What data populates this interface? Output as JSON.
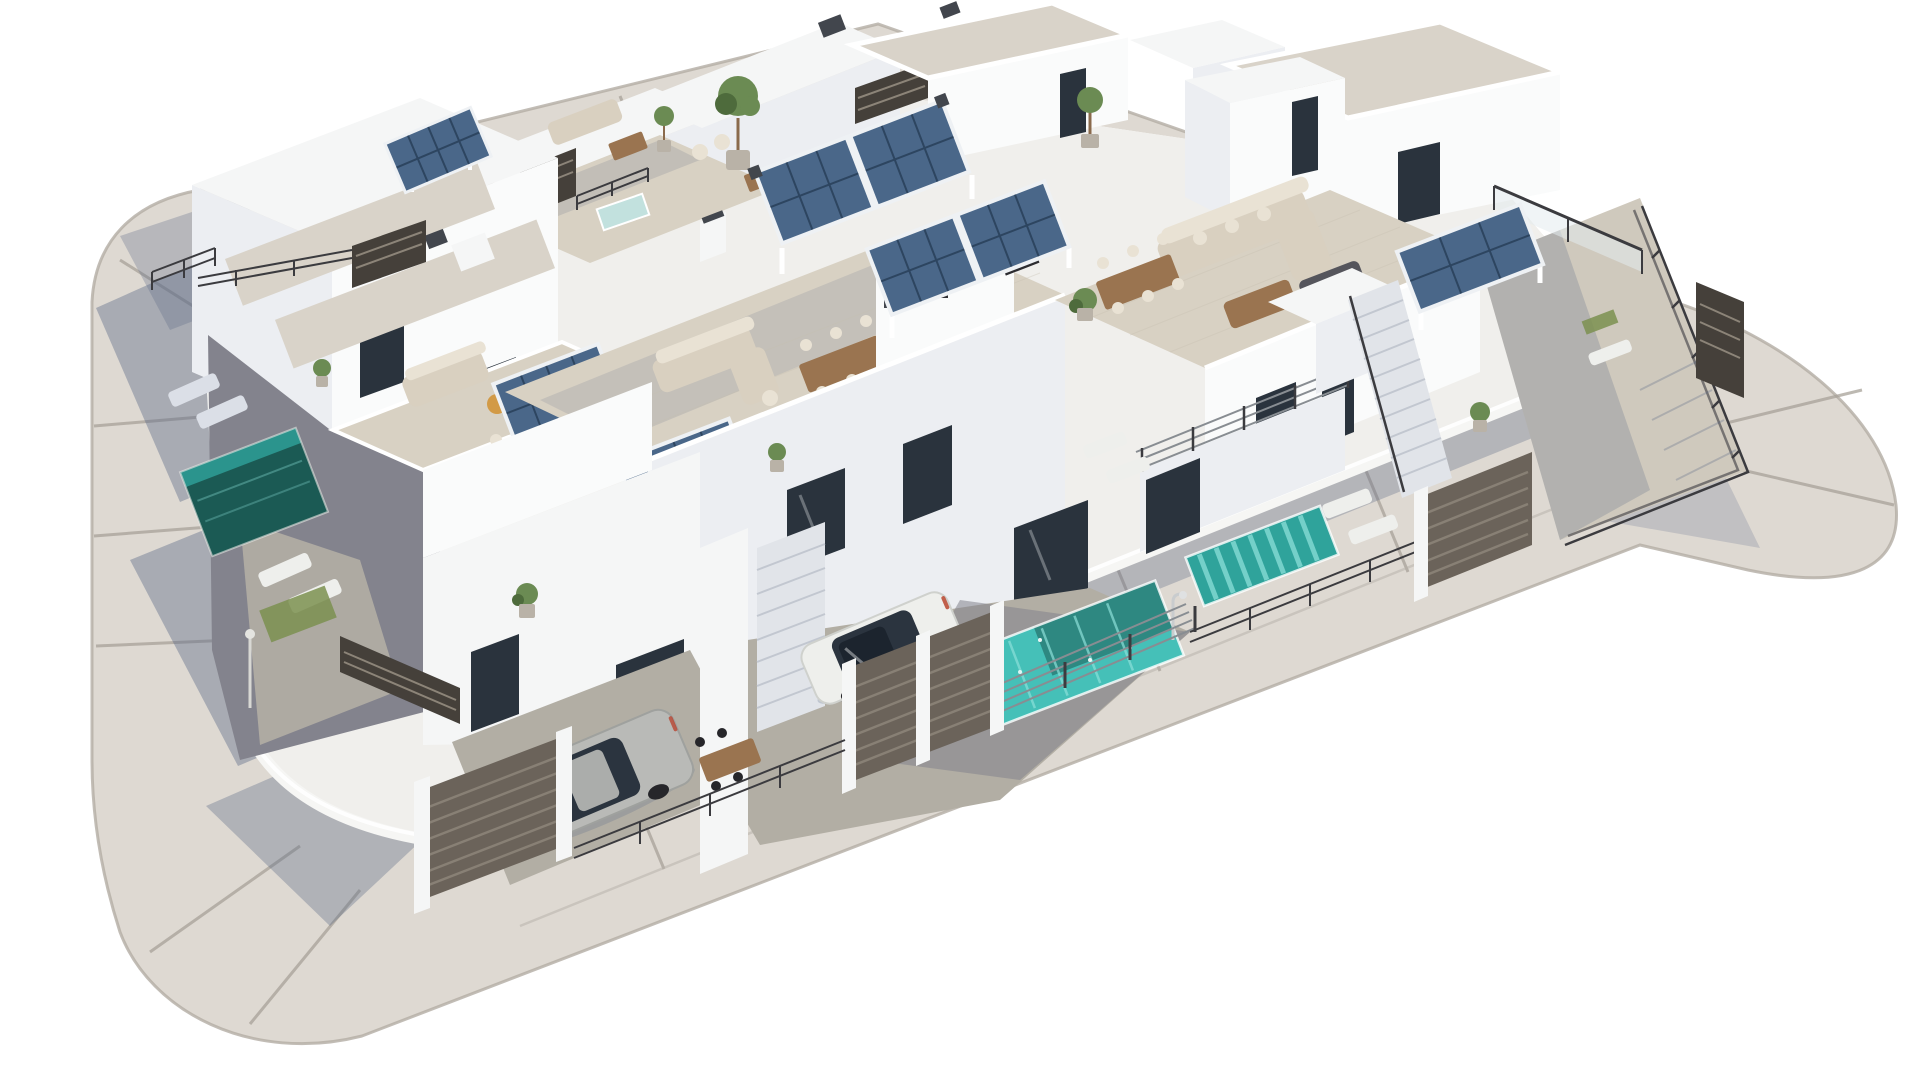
{
  "scene": {
    "type": "3d-architectural-render",
    "description": "Aerial 3D rendering of a modern white residential villa development on a rounded-corner island plot: flat-roofed cubic houses with beige tiled rooftop terraces, blue photovoltaic pergolas, turquoise plunge pools, outdoor lounge and dining furniture, dark slatted gates and fences, two parked cars, surrounded by a pale gray road on a white background.",
    "background": "#ffffff"
  },
  "inventory": {
    "houses": 8,
    "solar_pergolas": 6,
    "pools": 5,
    "cars": 2,
    "gates": 3,
    "staircases": 2,
    "roof_terraces": 6,
    "potted_plants": 11,
    "sun_loungers": 6,
    "dining_sets": 4,
    "sofas": 4
  },
  "colors": {
    "background": "#ffffff",
    "road": "#ded9d2",
    "road_seam": "#a8a299",
    "curb": "#b3ada4",
    "shadow": "#5d6b87",
    "plot": "#f0efec",
    "wall_white": "#f5f6f6",
    "facade_lit": "#fafbfb",
    "facade_shade": "#eceef2",
    "facade_dark": "#dbdfe7",
    "mosaic_roof": "#d9d3c9",
    "terrace": "#d8d1c3",
    "tile_line": "#c6bfb0",
    "patio_lit": "#b2aea4",
    "patio_shade": "#83838d",
    "glass": "#2a333d",
    "glass_frame": "#f8f8f8",
    "pool_dark": "#1b5a54",
    "pool_mid": "#2fa39b",
    "pool_bright": "#45c0b8",
    "pool_pale": "#c2e1de",
    "pool_stripe": "#8ce0d9",
    "solar": "#4a6789",
    "solar_line": "#2d4560",
    "solar_frame": "#eef1f4",
    "fence": "#45403a",
    "gate": "#6b635a",
    "gate_slat": "#8c8478",
    "rail": "#3b3b3f",
    "rail_metal": "#888d92",
    "green": "#6b8b53",
    "green_dark": "#4e6b3c",
    "trunk": "#8a6a4c",
    "pot": "#b9b2a7",
    "wood": "#9a7450",
    "sofa": "#d9d0c0",
    "sofa_light": "#e9e2d4",
    "cushion": "#d29a46",
    "car_silver": "#b9bab7",
    "car_white": "#eeefec",
    "car_glass": "#2b343f",
    "wheel": "#26262a",
    "stairs": "#e1e4e9",
    "step_line": "#c2c7d0",
    "grass": "#7b9050",
    "accent_red": "#b8452f",
    "ac_box": "#42464d"
  }
}
